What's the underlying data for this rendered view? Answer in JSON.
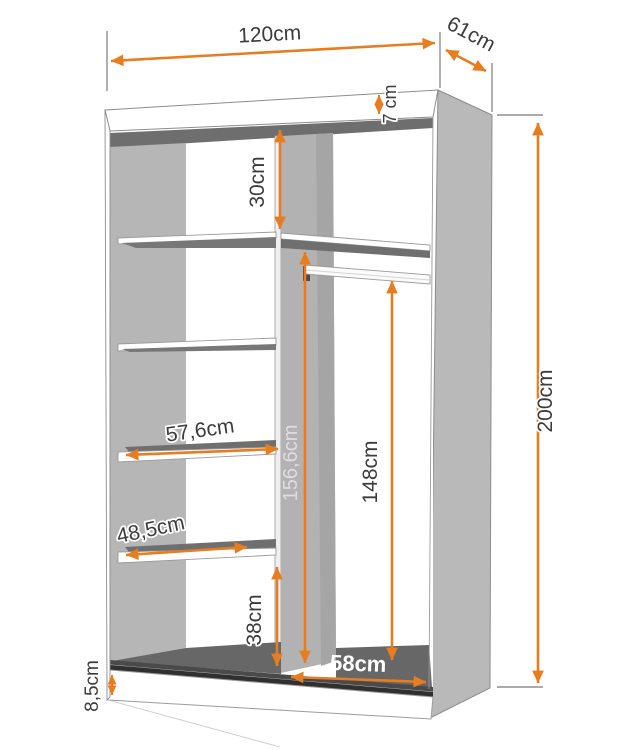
{
  "figure": {
    "kind": "wardrobe-interior-dimension-diagram",
    "unit": "cm"
  },
  "labels": {
    "width_top": "120cm",
    "depth_top": "61cm",
    "total_height": "200cm",
    "top_panel": "7 cm",
    "upper_gap": "30cm",
    "shelf_upper": "57,6cm",
    "shelf_lower": "48,5cm",
    "inner_height": "156,6cm",
    "hang_height": "148cm",
    "lower_gap": "38cm",
    "inner_width": "58cm",
    "plinth": "8,5cm"
  },
  "colors": {
    "accent_orange": "#E87D20",
    "panel_gray": "#B6B6B6",
    "shadow_gray": "#6E6E6E",
    "track_dark": "#3A3A3A",
    "line_gray": "#8C8C8C",
    "label_dark": "#3C3C3C"
  }
}
